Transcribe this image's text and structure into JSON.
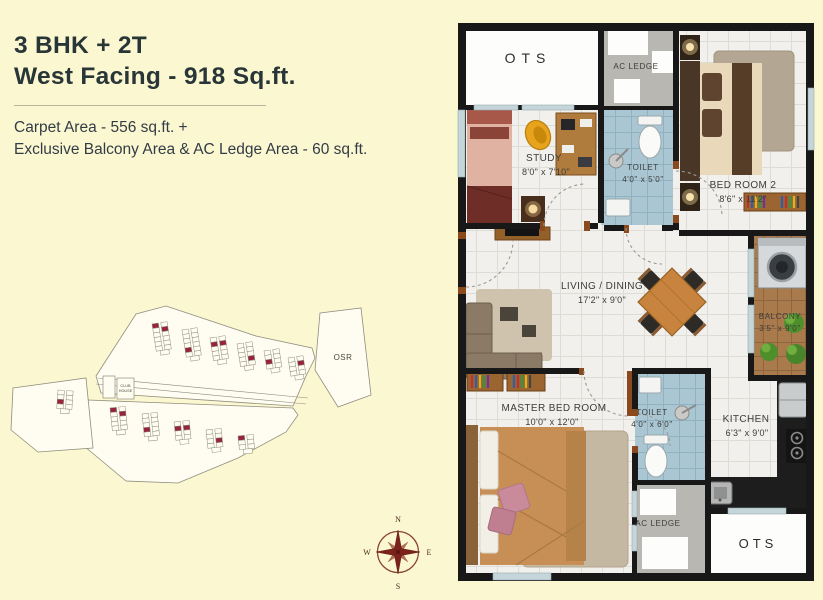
{
  "header": {
    "title_line1": "3 BHK + 2T",
    "title_line2": "West Facing - 918 Sq.ft.",
    "carpet_line1": "Carpet Area - 556 sq.ft. +",
    "carpet_line2": "Exclusive Balcony Area & AC Ledge Area - 60 sq.ft.",
    "title_color": "#293637",
    "body_color": "#333c46"
  },
  "floor_plan": {
    "rooms": {
      "ots_top": {
        "label": "OTS"
      },
      "ac_ledge_top": {
        "label": "AC LEDGE"
      },
      "study": {
        "label": "STUDY",
        "dims": "8'0\" x 7'10\""
      },
      "toilet_top": {
        "label": "TOILET",
        "dims": "4'0\" x 5'0\""
      },
      "bedroom2": {
        "label": "BED ROOM  2",
        "dims": "8'6\" x 11'2\""
      },
      "balcony": {
        "label": "BALCONY",
        "dims": "3'5\" x 9'0\""
      },
      "living": {
        "label": "LIVING / DINING",
        "dims": "17'2\" x 9'0\""
      },
      "master": {
        "label": "MASTER BED ROOM",
        "dims": "10'0\" x 12'0\""
      },
      "toilet_bottom": {
        "label": "TOILET",
        "dims": "4'0\" x 6'0\""
      },
      "kitchen": {
        "label": "KITCHEN",
        "dims": "6'3\" x 9'0\""
      },
      "ac_ledge_bottom": {
        "label": "AC LEDGE"
      },
      "ots_bottom": {
        "label": "OTS"
      }
    },
    "colors": {
      "wall": "#181818",
      "tile_floor": "#f1f0ed",
      "toilet_tile": "#a9c6d2",
      "balcony_tile": "#a87a4c",
      "ac_ledge": "#b9b7b2",
      "window": "#c5d6da",
      "door_frame": "#8a4a1e",
      "background": "#fbf7d1"
    }
  },
  "site_plan": {
    "osr_label": "OSR",
    "club_house_line1": "CLUB",
    "club_house_line2": "HOUSE",
    "highlight_color": "#96243a"
  },
  "compass": {
    "n": "N",
    "e": "E",
    "s": "S",
    "w": "W"
  }
}
